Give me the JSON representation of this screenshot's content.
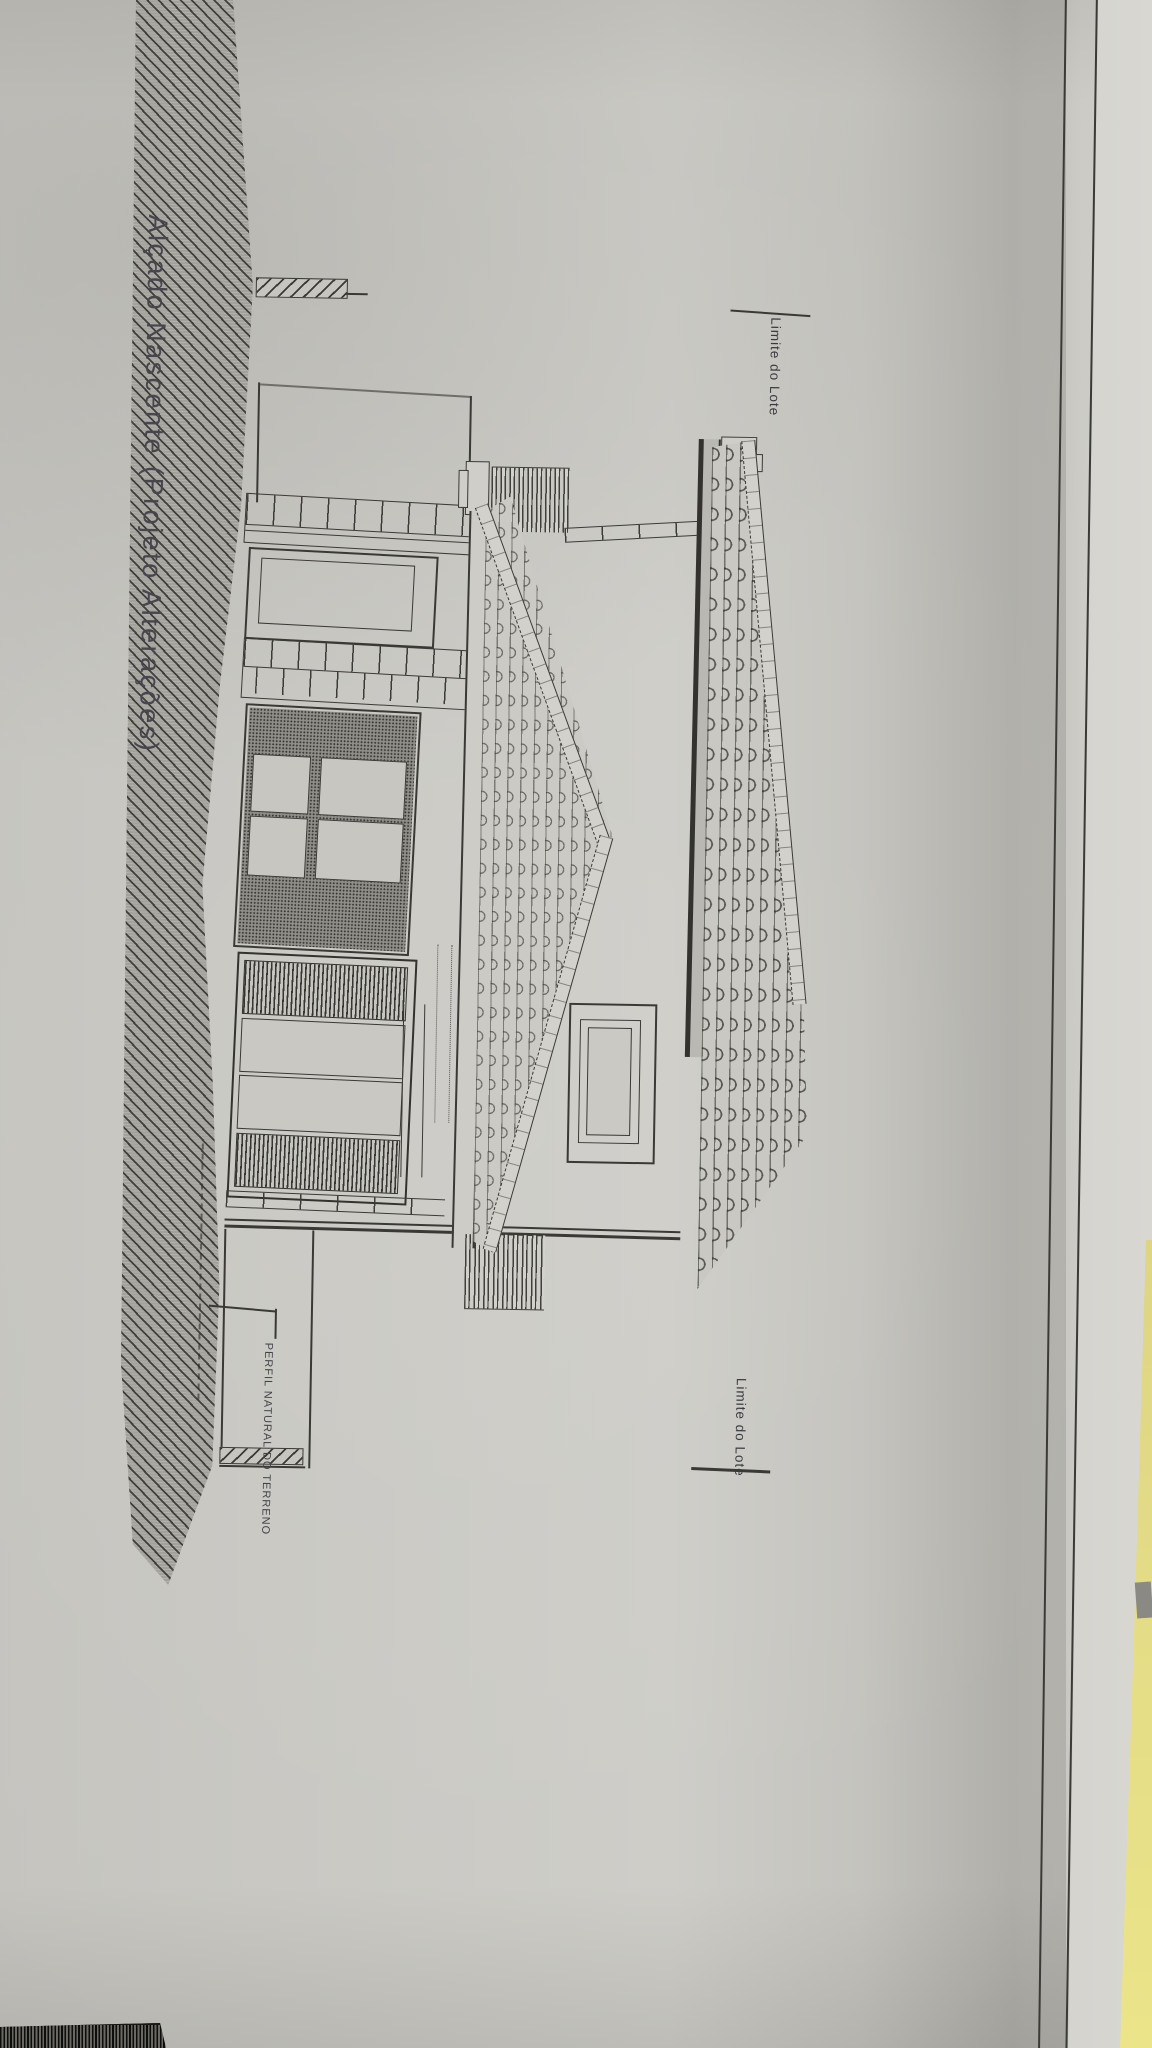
{
  "drawing": {
    "title": "Alçado Nascente (Projeto Alterações)",
    "labels": {
      "lot_boundary_top": "Limite do Lote",
      "lot_boundary_bottom": "Limite do Lote",
      "terrain_profile": "PERFIL NATURAL DO TERRENO"
    },
    "colors": {
      "paper": "#cac9c4",
      "ink": "#3a3935",
      "terrain_hatch": "#a3a19b",
      "folder_yellow": "#e8e08b",
      "under_sheet": "#d7d6d1"
    }
  }
}
